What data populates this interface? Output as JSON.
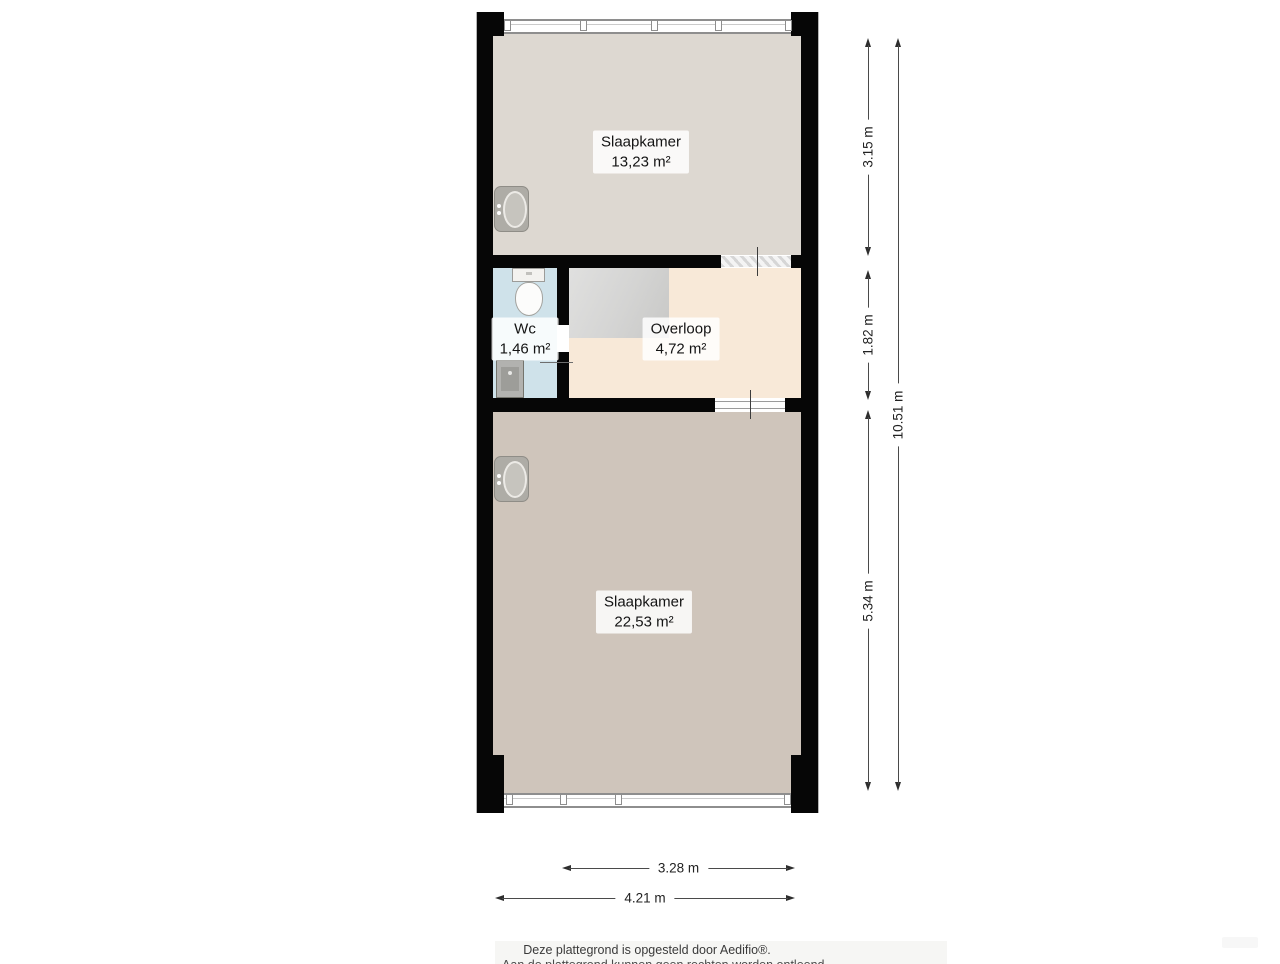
{
  "rooms": [
    {
      "name": "Slaapkamer",
      "area": "13,23 m²",
      "color": "#ddd8d1"
    },
    {
      "name": "Wc",
      "area": "1,46 m²",
      "color": "#cfe2ea"
    },
    {
      "name": "Overloop",
      "area": "4,72 m²",
      "color": "#f8e9d8"
    },
    {
      "name": "Slaapkamer",
      "area": "22,53 m²",
      "color": "#cfc5bb"
    }
  ],
  "dimensions": {
    "right": [
      {
        "label": "3.15 m"
      },
      {
        "label": "1.82 m"
      },
      {
        "label": "5.34 m"
      },
      {
        "label": "10.51 m"
      }
    ],
    "bottom": [
      {
        "label": "3.28 m"
      },
      {
        "label": "4.21 m"
      }
    ]
  },
  "fixtures": {
    "toilet": "toilet-icon",
    "washbasin": "washbasin-icon",
    "wc_sink": "sink-icon",
    "stairs": "stairs-icon"
  },
  "footer": {
    "line1": "Deze plattegrond is opgesteld door Aedifio®.",
    "line2": "Aan de plattegrond kunnen geen rechten worden ontleend."
  },
  "colors": {
    "wall": "#060606",
    "dimension_line": "#4a4a4a",
    "window_frame": "#8e8e8e",
    "label_background": "#ffffff"
  }
}
